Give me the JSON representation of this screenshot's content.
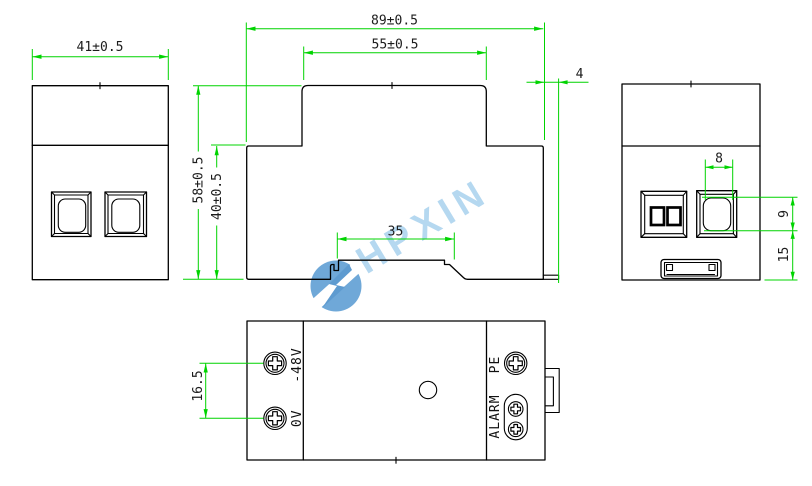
{
  "drawing": {
    "type": "mechanical-dimension-drawing",
    "background": "#ffffff",
    "outline_color": "#000000",
    "dimension_color": "#00d400",
    "views": {
      "front": {
        "dim_width": "41±0.5"
      },
      "side": {
        "dim_overall_width": "89±0.5",
        "dim_top_width": "55±0.5",
        "dim_height": "58±0.5",
        "dim_lower_height": "40±0.5",
        "dim_rail_width": "35",
        "dim_clip_offset": "4"
      },
      "end": {
        "dim_button_width": "8",
        "dim_button_height": "9",
        "dim_bottom_offset": "15"
      },
      "bottom": {
        "dim_terminal_pitch": "16.5",
        "label_neg48v": "-48V",
        "label_0v": "0V",
        "label_pe": "PE",
        "label_alarm": "ALARM"
      }
    },
    "watermark": {
      "brand": "HPXIN",
      "text_color": "#b5d8f0",
      "logo_color": "#6fa8d8"
    }
  }
}
